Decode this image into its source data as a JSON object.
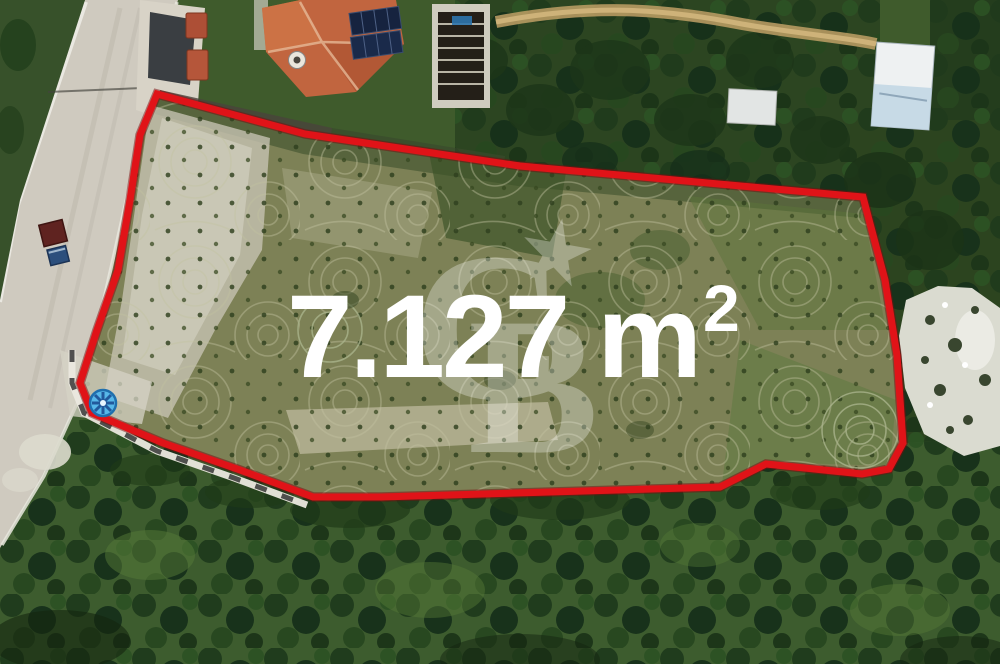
{
  "meta": {
    "description": "Aerial drone photograph of a land parcel outlined for sale"
  },
  "overlay": {
    "area_value": "7.127 m",
    "area_superscript": "2",
    "area_full": "7.127 m²",
    "boundary_color": "#e01318",
    "label_color": "#ffffff"
  },
  "watermark": {
    "letter_c": "C",
    "letter_b": "B",
    "star_icon": "★"
  },
  "colors": {
    "marker_blue": "#57b7e9",
    "field_green": "#7d8156",
    "orchard_green": "#3d5c2e",
    "road_gray": "#cfcabf",
    "roof_orange": "#c1653f",
    "rock_white": "#dadbd0"
  }
}
